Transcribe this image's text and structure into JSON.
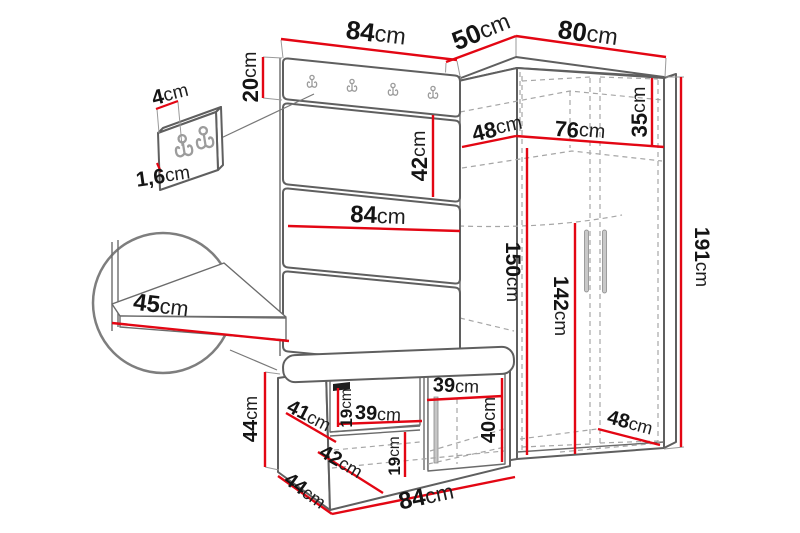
{
  "diagram": {
    "type": "furniture-dimension-diagram",
    "subject": "hallway set: coat-hook panel with bench and corner wardrobe, with detail insets",
    "unit": "cm",
    "colors": {
      "dimension_line": "#e30613",
      "outline": "#5f5f5f",
      "text": "#141414",
      "background": "#ffffff"
    },
    "dims": {
      "panel_width_top": {
        "num": "84",
        "unit": "cm"
      },
      "top_depth": {
        "num": "50",
        "unit": "cm"
      },
      "wardrobe_width": {
        "num": "80",
        "unit": "cm"
      },
      "rail_height": {
        "num": "20",
        "unit": "cm"
      },
      "hook_width": {
        "num": "4",
        "unit": "cm"
      },
      "hook_panel_thickness": {
        "num": "1,6",
        "unit": "cm"
      },
      "panel_section_height": {
        "num": "42",
        "unit": "cm"
      },
      "panel_width_mid": {
        "num": "84",
        "unit": "cm"
      },
      "shelf_depth": {
        "num": "45",
        "unit": "cm"
      },
      "wardrobe_inner_depth_top": {
        "num": "48",
        "unit": "cm"
      },
      "wardrobe_inner_width": {
        "num": "76",
        "unit": "cm"
      },
      "top_shelf_height": {
        "num": "35",
        "unit": "cm"
      },
      "wardrobe_height": {
        "num": "191",
        "unit": "cm"
      },
      "inner_height_left": {
        "num": "150",
        "unit": "cm"
      },
      "hanging_height": {
        "num": "142",
        "unit": "cm"
      },
      "bench_height": {
        "num": "44",
        "unit": "cm"
      },
      "bench_inner_depth": {
        "num": "41",
        "unit": "cm"
      },
      "bench_flap_height": {
        "num": "19",
        "unit": "cm"
      },
      "bench_shelf_width": {
        "num": "39",
        "unit": "cm"
      },
      "bench_lower_depth": {
        "num": "42",
        "unit": "cm"
      },
      "bench_lower_height": {
        "num": "19",
        "unit": "cm"
      },
      "bench_door_width": {
        "num": "39",
        "unit": "cm"
      },
      "bench_door_height": {
        "num": "40",
        "unit": "cm"
      },
      "bench_depth": {
        "num": "44",
        "unit": "cm"
      },
      "bench_width": {
        "num": "84",
        "unit": "cm"
      },
      "wardrobe_inner_depth_bottom": {
        "num": "48",
        "unit": "cm"
      }
    }
  }
}
